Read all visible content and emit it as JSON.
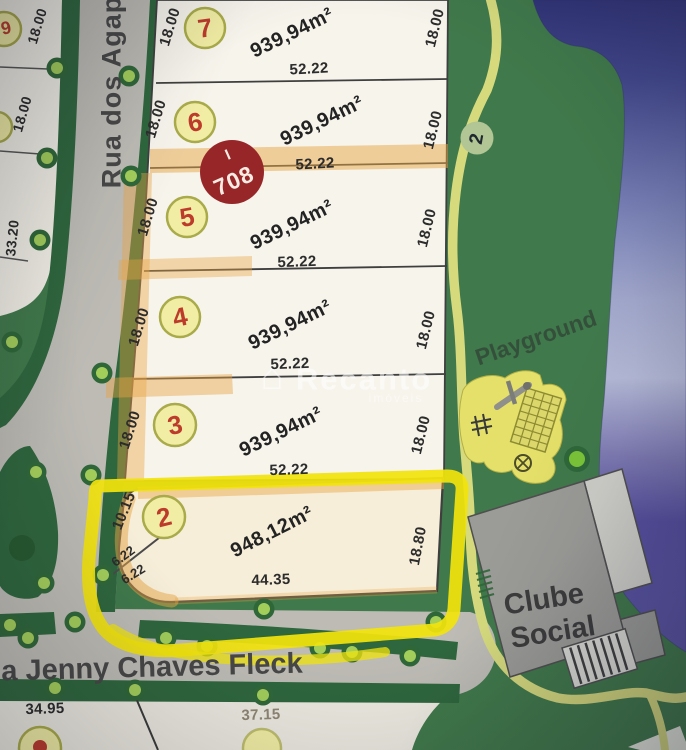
{
  "streets": {
    "vertical": "Rua dos Agap",
    "horizontal": "a Jenny Chaves Fleck"
  },
  "places": {
    "playground": "Playground",
    "club_line1": "Clube",
    "club_line2": "Social"
  },
  "watermark": {
    "brand": "Recanto",
    "subtitle": "imóveis",
    "house_icon": "⌂"
  },
  "markers": {
    "block_tick": "I",
    "block_number": "708",
    "path_point": "2"
  },
  "lot_rows": [
    {
      "number": "7",
      "area": "939,94m²",
      "front": "52.22",
      "side_left": "18.00",
      "side_right": "18.00"
    },
    {
      "number": "6",
      "area": "939,94m²",
      "front": "52.22",
      "side_left": "18.00",
      "side_right": "18.00"
    },
    {
      "number": "5",
      "area": "939,94m²",
      "front": "52.22",
      "side_left": "18.00",
      "side_right": "18.00"
    },
    {
      "number": "4",
      "area": "939,94m²",
      "front": "52.22",
      "side_left": "18.00",
      "side_right": "18.00"
    },
    {
      "number": "3",
      "area": "939,94m²",
      "front": "52.22",
      "side_left": "18.00",
      "side_right": "18.00"
    },
    {
      "number": "2",
      "area": "948,12m²",
      "front": "44.35",
      "side_left": "10.15",
      "side_right": "18.80",
      "split_upper": "6.22",
      "split_lower": "6.22"
    }
  ],
  "highlighted_lot": {
    "number": "2",
    "area": "948,12m²"
  },
  "left_block": {
    "dim_top": "18.00",
    "dim_mid": "18.00",
    "dim_bottom": "33.20",
    "lot_number_top": "9",
    "lot_number_mid": "8"
  },
  "bottom_block": {
    "dim_left": "34.95",
    "dim_right": "37.15"
  },
  "colors": {
    "highlight": "#f2e402",
    "map_green": "#3e7a49",
    "lake_blue": "#31347a",
    "lot_number_red": "#c23a28",
    "block_marker_red": "#9c2528",
    "path_yellow": "#d6da79"
  }
}
